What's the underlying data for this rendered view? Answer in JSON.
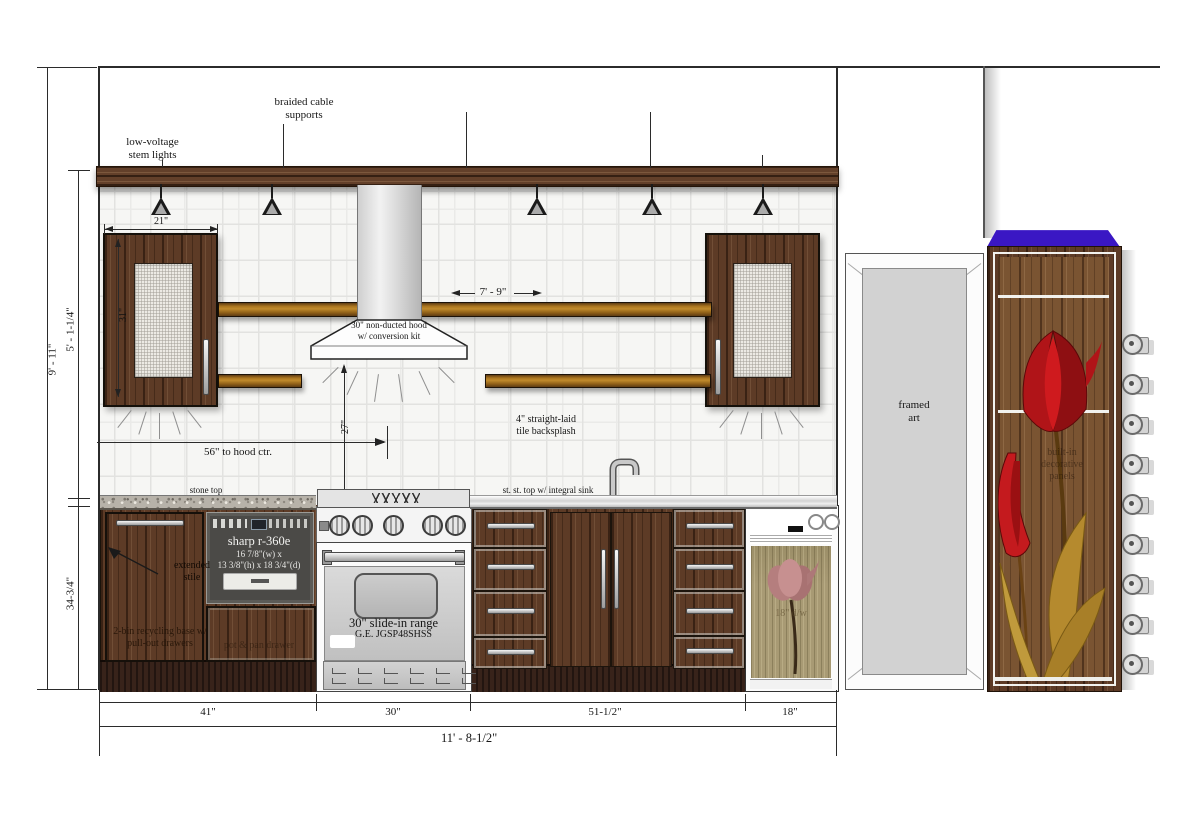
{
  "annotations": {
    "low_voltage": "low-voltage\nstem lights",
    "braided_cable": "braided cable\nsupports",
    "hood": "30\" non-ducted hood\nw/ conversion kit",
    "backsplash": "4\" straight-laid\ntile backsplash",
    "stone_top": "stone top",
    "stainless_top": "st. st. top w/ integral sink",
    "extended_stile": "extended\nstile",
    "recycling": "2-bin recycling base w/\npull-out drawers",
    "framed_art": "framed\nart"
  },
  "appliances": {
    "microwave": {
      "name": "sharp r-360e",
      "dims1": "16 7/8\"(w) x",
      "dims2": "13 3/8\"(h) x 18 3/4\"(d)"
    },
    "range": {
      "name": "30\" slide-in range",
      "model": "G.E. JGSP48SHSS"
    },
    "dishwasher_faint": "18\" d/w",
    "pan_drawer_faint": "pot & pan drawer",
    "tall_cabinet_faint": "built-in\ndecorative\npanels"
  },
  "dimensions": {
    "wall_height": "9' - 11\"",
    "upper_section": "5' - 1-1/4\"",
    "counter_height": "34-3/4\"",
    "upper_cab_width": "21\"",
    "upper_cab_height": "31\"",
    "shelf_length": "7' - 9\"",
    "hood_clearance": "27\"",
    "hood_center": "56\" to hood ctr.",
    "seg_41": "41\"",
    "seg_30": "30\"",
    "seg_51": "51-1/2\"",
    "seg_18": "18\"",
    "total_width": "11' - 8-1/2\""
  },
  "colors": {
    "wood_dark": "#5d3b26",
    "wood_face": "#7a5432",
    "shelf_gold": "#c08a2b",
    "accent_blue": "#3a17c4",
    "tulip_red": "#b01418",
    "leaf_gold": "#b58a2e",
    "dishwasher_panel": "#a89a74"
  },
  "icons": {
    "pendant_light": "triangle-pendant",
    "cup_hook": "round-hook",
    "faucet": "gooseneck-faucet",
    "tulip": "tulip-flower",
    "light_rays": "ray-lines"
  }
}
